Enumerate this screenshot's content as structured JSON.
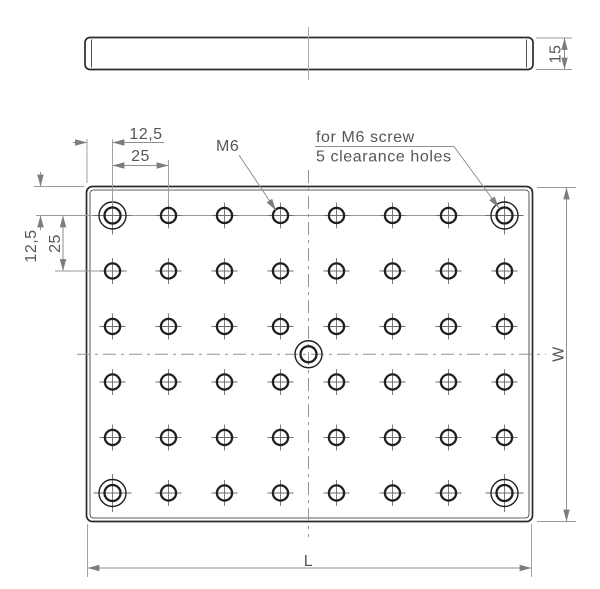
{
  "side_view": {
    "thickness_label": "15"
  },
  "plan_view": {
    "dims": {
      "pitch_x_offset": "12,5",
      "pitch_x": "25",
      "pitch_y_offset": "12,5",
      "pitch_y": "25",
      "length": "L",
      "width": "W"
    },
    "annotations": {
      "thread_label": "M6",
      "clearance_note_line1": "for M6 screw",
      "clearance_note_line2": "5 clearance holes"
    },
    "grid": {
      "cols": 8,
      "rows": 6,
      "x0": 112.5,
      "y0": 215.5,
      "dx": 56,
      "dy": 55.5,
      "tapped_r": 7.6,
      "tapped_tick": 13,
      "clearance_outer_r": 13.5,
      "clearance_inner_r": 8,
      "clearance_tick": 19,
      "center_hole": {
        "x": 308.5,
        "y": 354.25
      }
    }
  },
  "colors": {
    "outline": "#2b2b2b",
    "hole": "#1f1f1f",
    "dimension": "#8f8f8f",
    "arrow": "#7d7d7d",
    "text": "#565656",
    "centerline": "#949494"
  }
}
